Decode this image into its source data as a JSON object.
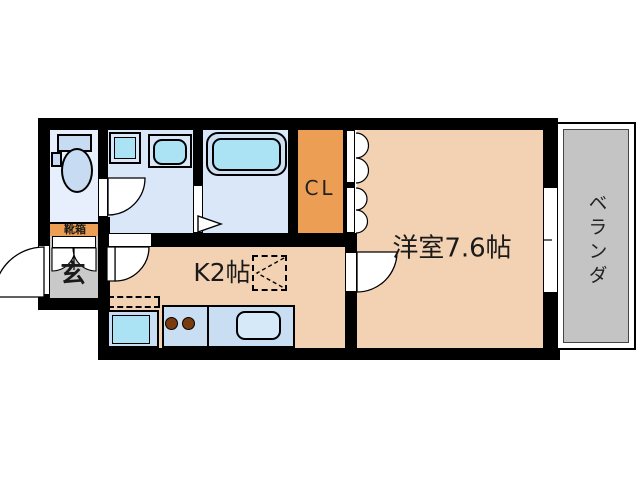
{
  "title": "apartment-floor-plan",
  "palette": {
    "wall": "#000000",
    "wet_room": "#d9e7f8",
    "toilet_room": "#e6effb",
    "tatami": "#f3d2b3",
    "closet_orange": "#eb9e54",
    "entrance_gray": "#c9c9c9",
    "balcony_gray": "#c4c4c4",
    "fixture_blue": "#c7dcf3",
    "counter_blue": "#c9def2",
    "water_cyan": "#abe3f5",
    "sink_blue": "#d5e9f8",
    "burner_brown": "#7a3a10"
  },
  "rooms": {
    "western": {
      "label": "洋室7.6帖"
    },
    "kitchen": {
      "label": "K2帖"
    },
    "closet": {
      "label": "CL"
    },
    "balcony": {
      "label": "ベランダ"
    },
    "entrance": {
      "label": "玄"
    },
    "shoe_box": {
      "label": "靴箱"
    }
  }
}
